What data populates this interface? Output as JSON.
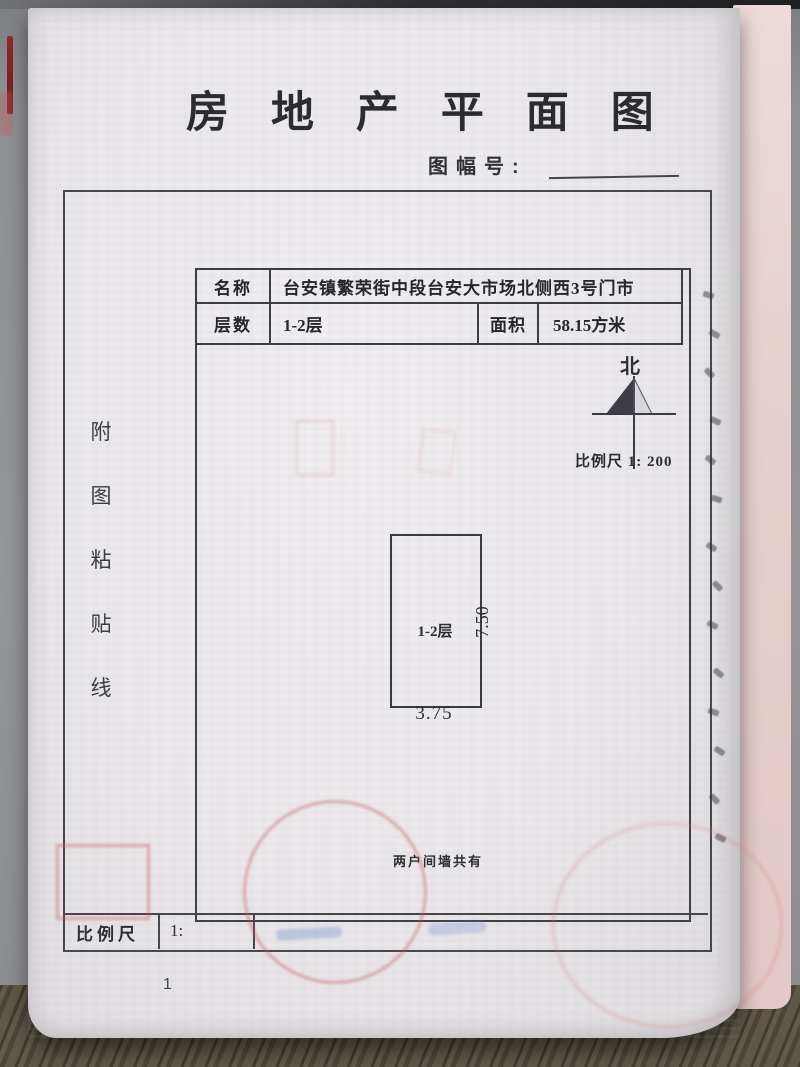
{
  "page": {
    "title": "房 地 产 平 面 图",
    "sheet_number_label": "图幅号:",
    "paste_line_chars": [
      "附",
      "图",
      "粘",
      "贴",
      "线"
    ],
    "info_table": {
      "name_label": "名称",
      "name_value": "台安镇繁荣街中段台安大市场北侧西3号门市",
      "floors_label": "层数",
      "floors_value": "1-2层",
      "area_label": "面积",
      "area_value": "58.15方米"
    },
    "north_label": "北",
    "scale_annotation": "比例尺 1: 200",
    "floor_plan": {
      "unit_label": "1-2层",
      "bottom_dimension": "3.75",
      "right_dimension": "7.50",
      "note": "两户间墙共有"
    },
    "footer_scale": {
      "label": "比例尺",
      "value_prefix": "1:"
    },
    "page_number": "1"
  },
  "colors": {
    "frame_line": "#47474c",
    "ink": "#2b2b2f",
    "stamp_red": "#c65858",
    "ghost_blue": "#687ec6",
    "pink_page": "#e6cfce",
    "desk_gray": "#949699",
    "wood_brown": "#5e5747"
  }
}
